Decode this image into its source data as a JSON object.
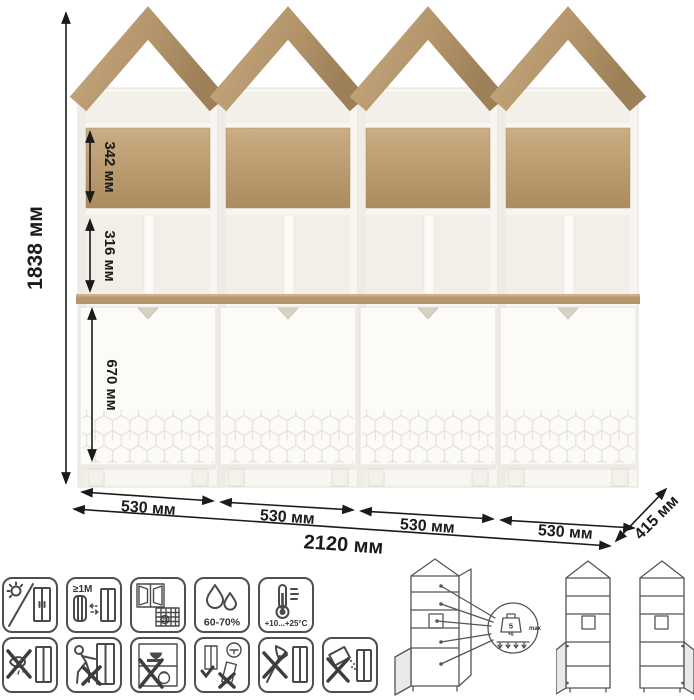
{
  "dimensions": {
    "height": "1838 мм",
    "top_section": "342 мм",
    "middle_section": "316 мм",
    "bottom_section": "670 мм",
    "unit_widths": [
      "530 мм",
      "530 мм",
      "530 мм",
      "530 мм"
    ],
    "total_width": "2120 мм",
    "depth": "415 мм"
  },
  "care_icons": {
    "row1": [
      {
        "name": "no-direct-sunlight"
      },
      {
        "name": "keep-distance-from-heaters",
        "label": "≥1M"
      },
      {
        "name": "ventilate-room",
        "calendar_day": "21"
      },
      {
        "name": "humidity-range",
        "label": "60-70%"
      },
      {
        "name": "temperature-range",
        "label": "+10...+25°C"
      }
    ],
    "row2": [
      {
        "name": "no-wet-abrasive-cleaning"
      },
      {
        "name": "do-not-push-or-drag"
      },
      {
        "name": "no-heavy-objects-inside"
      },
      {
        "name": "install-level-and-adjust"
      },
      {
        "name": "no-sharp-tools"
      },
      {
        "name": "no-spilling-liquids"
      }
    ]
  },
  "load_diagram": {
    "weight_value": "5",
    "weight_unit": "kg",
    "max_label": "max"
  },
  "colors": {
    "wood": "#b8996e",
    "body_white": "#f8f6f2",
    "annotation": "#1b1b1b",
    "icon_line": "#4a4a4a"
  }
}
